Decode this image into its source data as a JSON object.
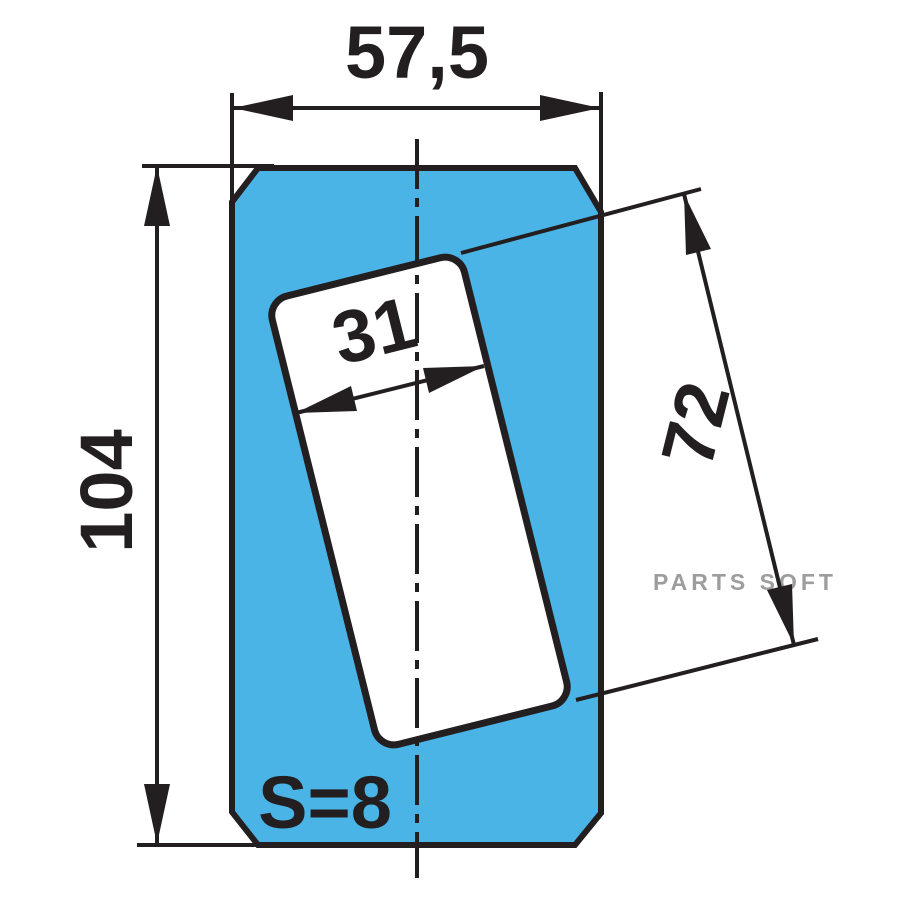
{
  "drawing": {
    "type": "technical-dimension-drawing",
    "dimensions": {
      "overall_width": "57,5",
      "overall_height": "104",
      "slot_width": "31",
      "slot_length": "72",
      "thickness": "S=8"
    },
    "watermark": "PARTS SOFT",
    "colors": {
      "background": "#ffffff",
      "part_fill": "#4bb4e6",
      "slot_fill": "#ffffff",
      "line": "#231f20",
      "watermark": "#9d9d9d"
    }
  }
}
